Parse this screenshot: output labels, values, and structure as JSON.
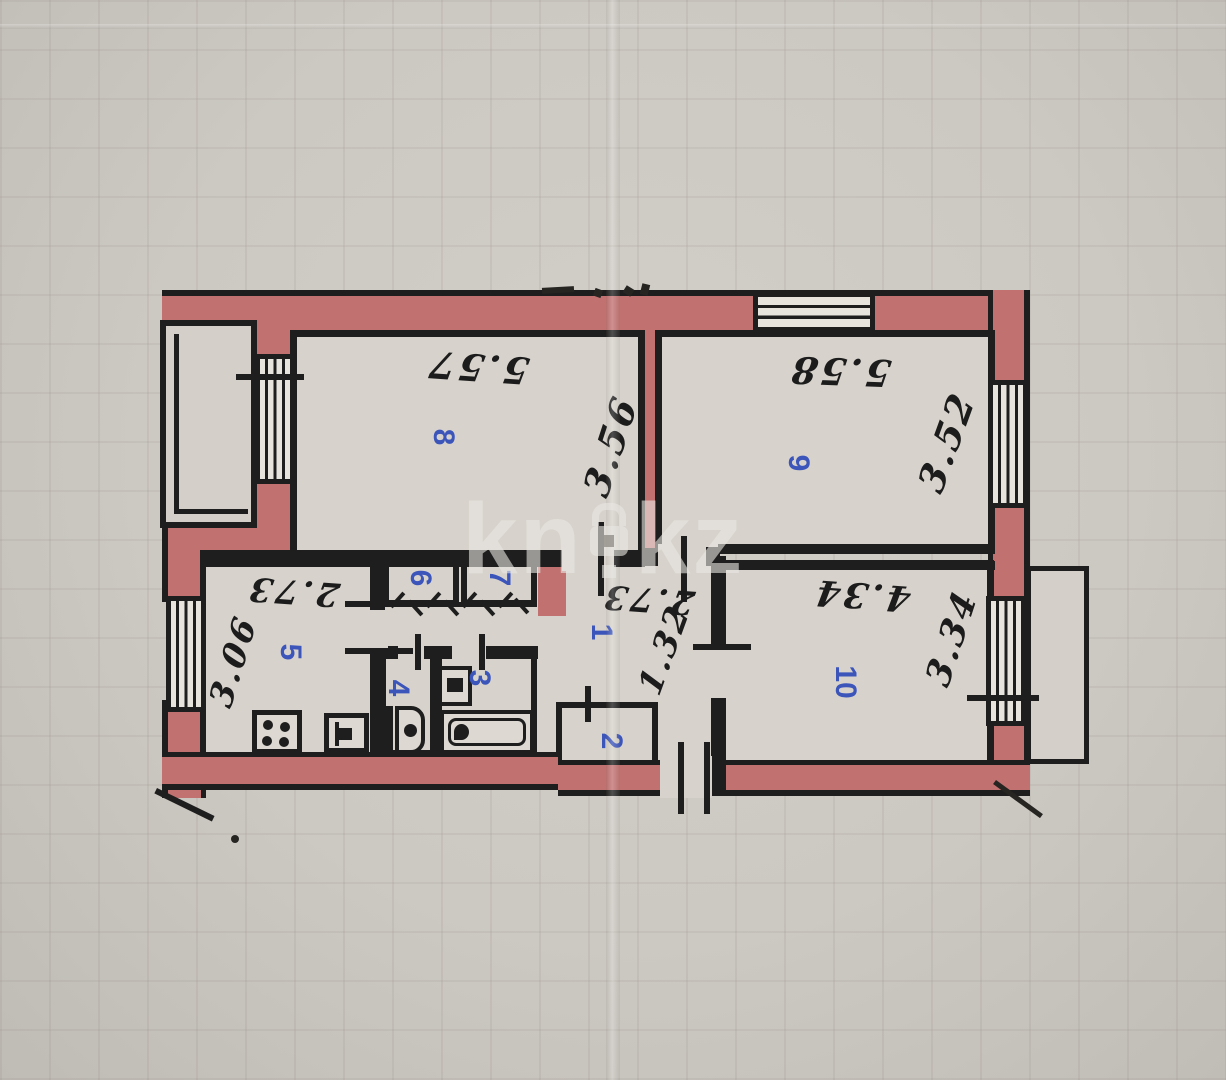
{
  "watermark": {
    "left": "kn",
    "right": "kz"
  },
  "rooms": {
    "r1": {
      "number": "1",
      "dim_w": "2.73",
      "dim_h": "1.32"
    },
    "r2": {
      "number": "2"
    },
    "r3": {
      "number": "3"
    },
    "r4": {
      "number": "4"
    },
    "r5": {
      "number": "5",
      "dim_w": "2.73",
      "dim_h": "3.06"
    },
    "r6": {
      "number": "6"
    },
    "r7": {
      "number": "7"
    },
    "r8": {
      "number": "8",
      "dim_w": "5.57",
      "dim_h": "3.56"
    },
    "r9": {
      "number": "9",
      "dim_w": "5.58",
      "dim_h": "3.52"
    },
    "r10": {
      "number": "10",
      "dim_w": "4.34",
      "dim_h": "3.34"
    }
  },
  "colors": {
    "wall_fill": "#c17170",
    "line": "#1e1e1e",
    "room_number": "#3c55bb",
    "paper": "#ccc8c2"
  }
}
